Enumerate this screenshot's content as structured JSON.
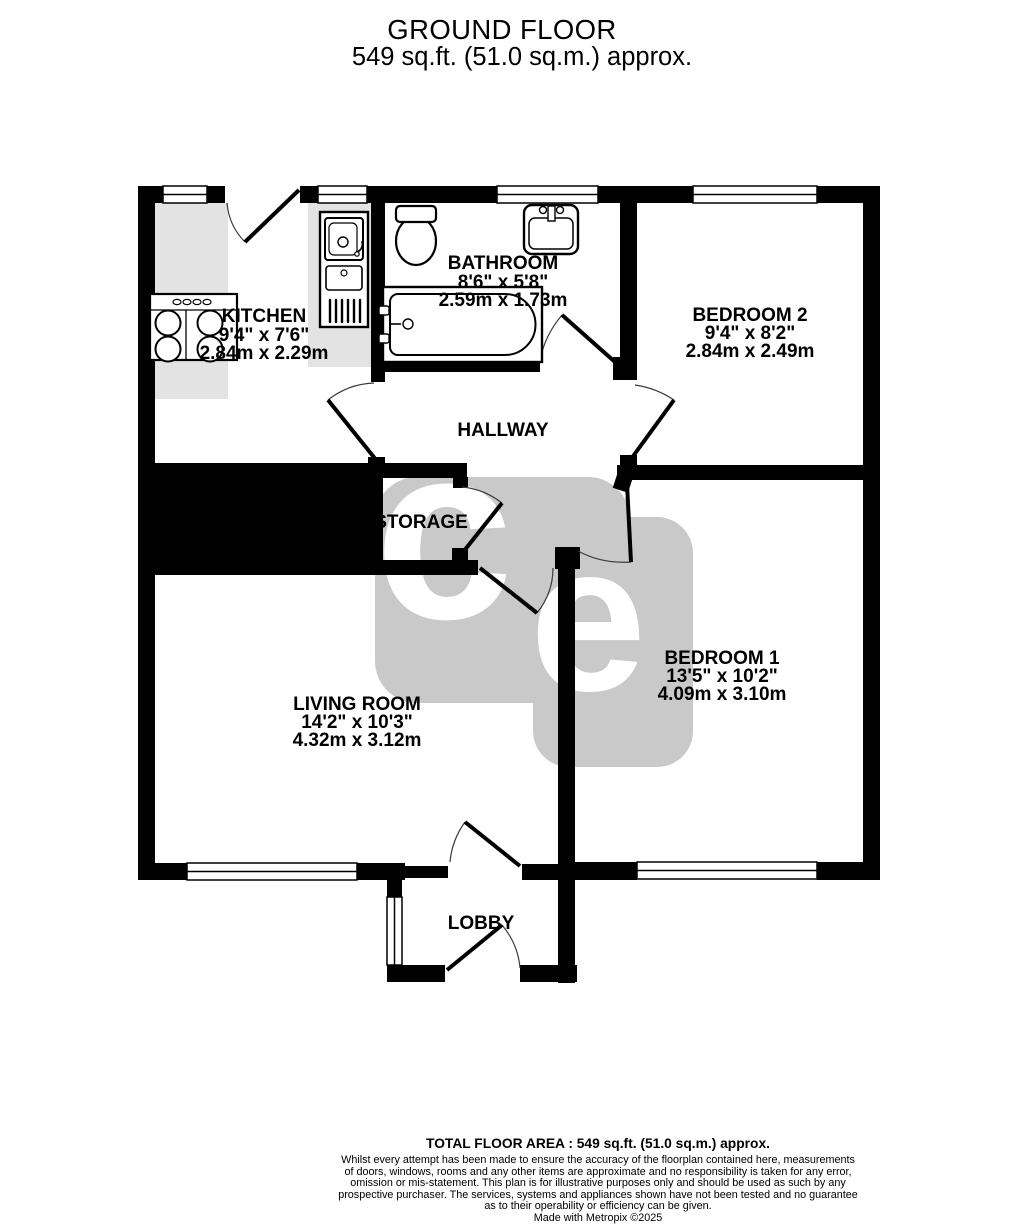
{
  "header": {
    "title": "GROUND FLOOR",
    "subtitle": "549 sq.ft. (51.0 sq.m.) approx."
  },
  "rooms": {
    "kitchen": {
      "name": "KITCHEN",
      "imperial": "9'4\"  x 7'6\"",
      "metric": "2.84m  x 2.29m"
    },
    "bathroom": {
      "name": "BATHROOM",
      "imperial": "8'6\"  x 5'8\"",
      "metric": "2.59m  x 1.73m"
    },
    "bedroom2": {
      "name": "BEDROOM 2",
      "imperial": "9'4\"  x 8'2\"",
      "metric": "2.84m  x 2.49m"
    },
    "hallway": {
      "name": "HALLWAY"
    },
    "storage": {
      "name": "STORAGE"
    },
    "living_room": {
      "name": "LIVING ROOM",
      "imperial": "14'2\"  x 10'3\"",
      "metric": "4.32m  x 3.12m"
    },
    "bedroom1": {
      "name": "BEDROOM 1",
      "imperial": "13'5\"  x 10'2\"",
      "metric": "4.09m  x 3.10m"
    },
    "lobby": {
      "name": "LOBBY"
    }
  },
  "watermark": {
    "letter1": "c",
    "letter2": "e"
  },
  "footer": {
    "total_area": "TOTAL FLOOR AREA : 549 sq.ft. (51.0 sq.m.) approx.",
    "disclaimer_lines": [
      "Whilst every attempt has been made to ensure the accuracy of the floorplan contained here, measurements",
      "of doors, windows, rooms and any other items are approximate and no responsibility is taken for any error,",
      "omission or mis-statement. This plan is for illustrative purposes only and should be used as such by any",
      "prospective purchaser. The services, systems and appliances shown have not been tested and no guarantee",
      "as to their operability or efficiency can be given."
    ],
    "credit": "Made with Metropix ©2025"
  },
  "colors": {
    "wall": "#000000",
    "counter": "#e3e3e3",
    "watermark_tile": "#c9c9c9"
  }
}
